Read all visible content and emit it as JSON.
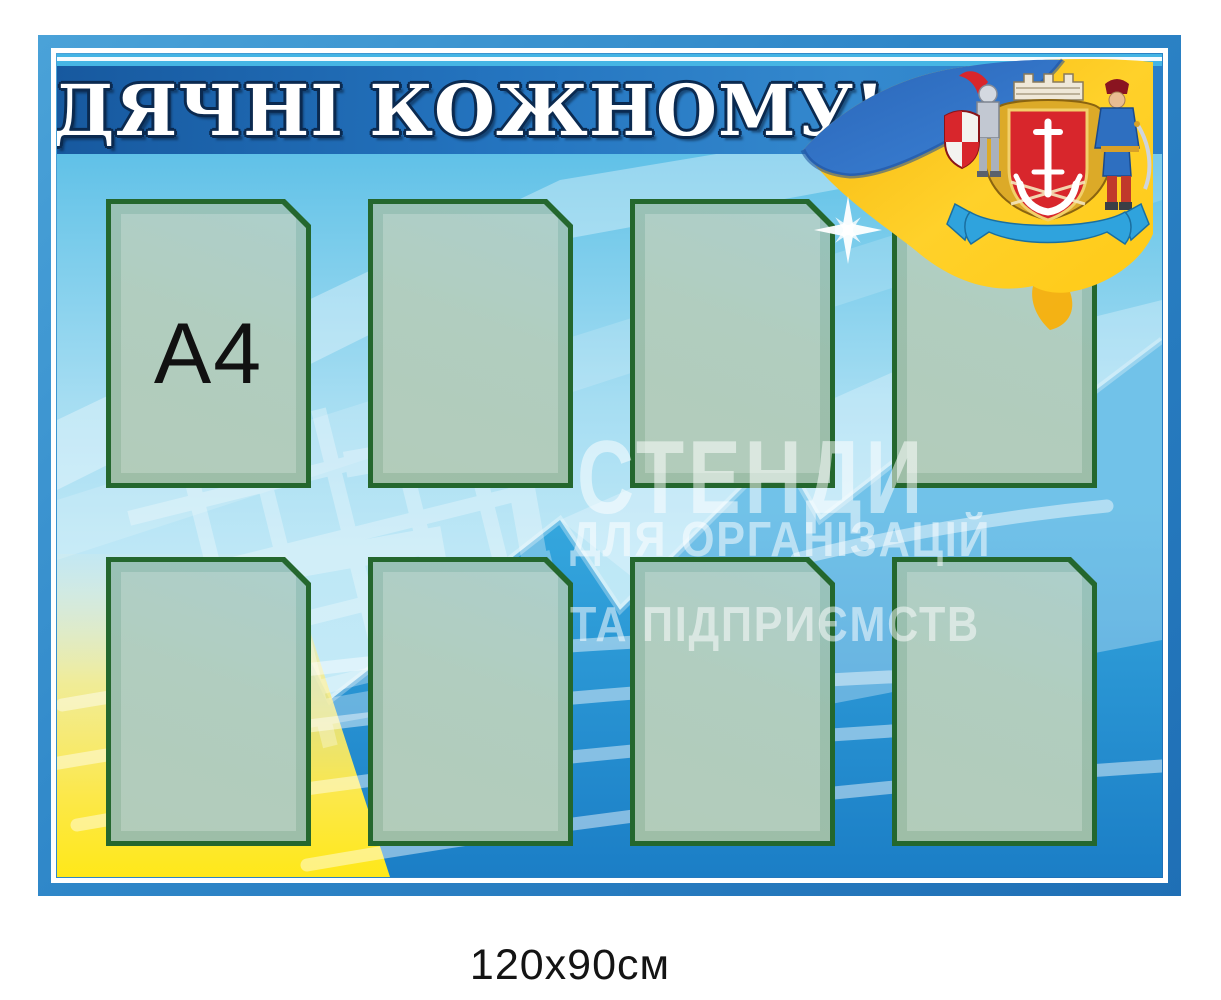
{
  "board": {
    "title": "ВДЯЧНІ КОЖНОМУ!",
    "size_caption": "120x90см"
  },
  "pocket": {
    "count": 8,
    "format_label": "А4"
  },
  "watermark": {
    "line1": "СТЕНДИ",
    "line2": "ДЛЯ ОРГАНІЗАЦІЙ",
    "line3": "ТА ПІДПРИЄМСТВ"
  },
  "emblem": {
    "flag_icon": "ukraine-flag",
    "crest_icon": "vinnytsia-coat-of-arms"
  },
  "colors": {
    "header_blue": "#1d66b4",
    "frame_blue": "#2e86c8",
    "pocket_border_green": "#24672e",
    "wave_blue": "#1e88cd",
    "corner_yellow": "#ffe819",
    "flag_blue": "#2e6fc0",
    "flag_yellow": "#ffc913",
    "shield_red": "#d8262c"
  }
}
